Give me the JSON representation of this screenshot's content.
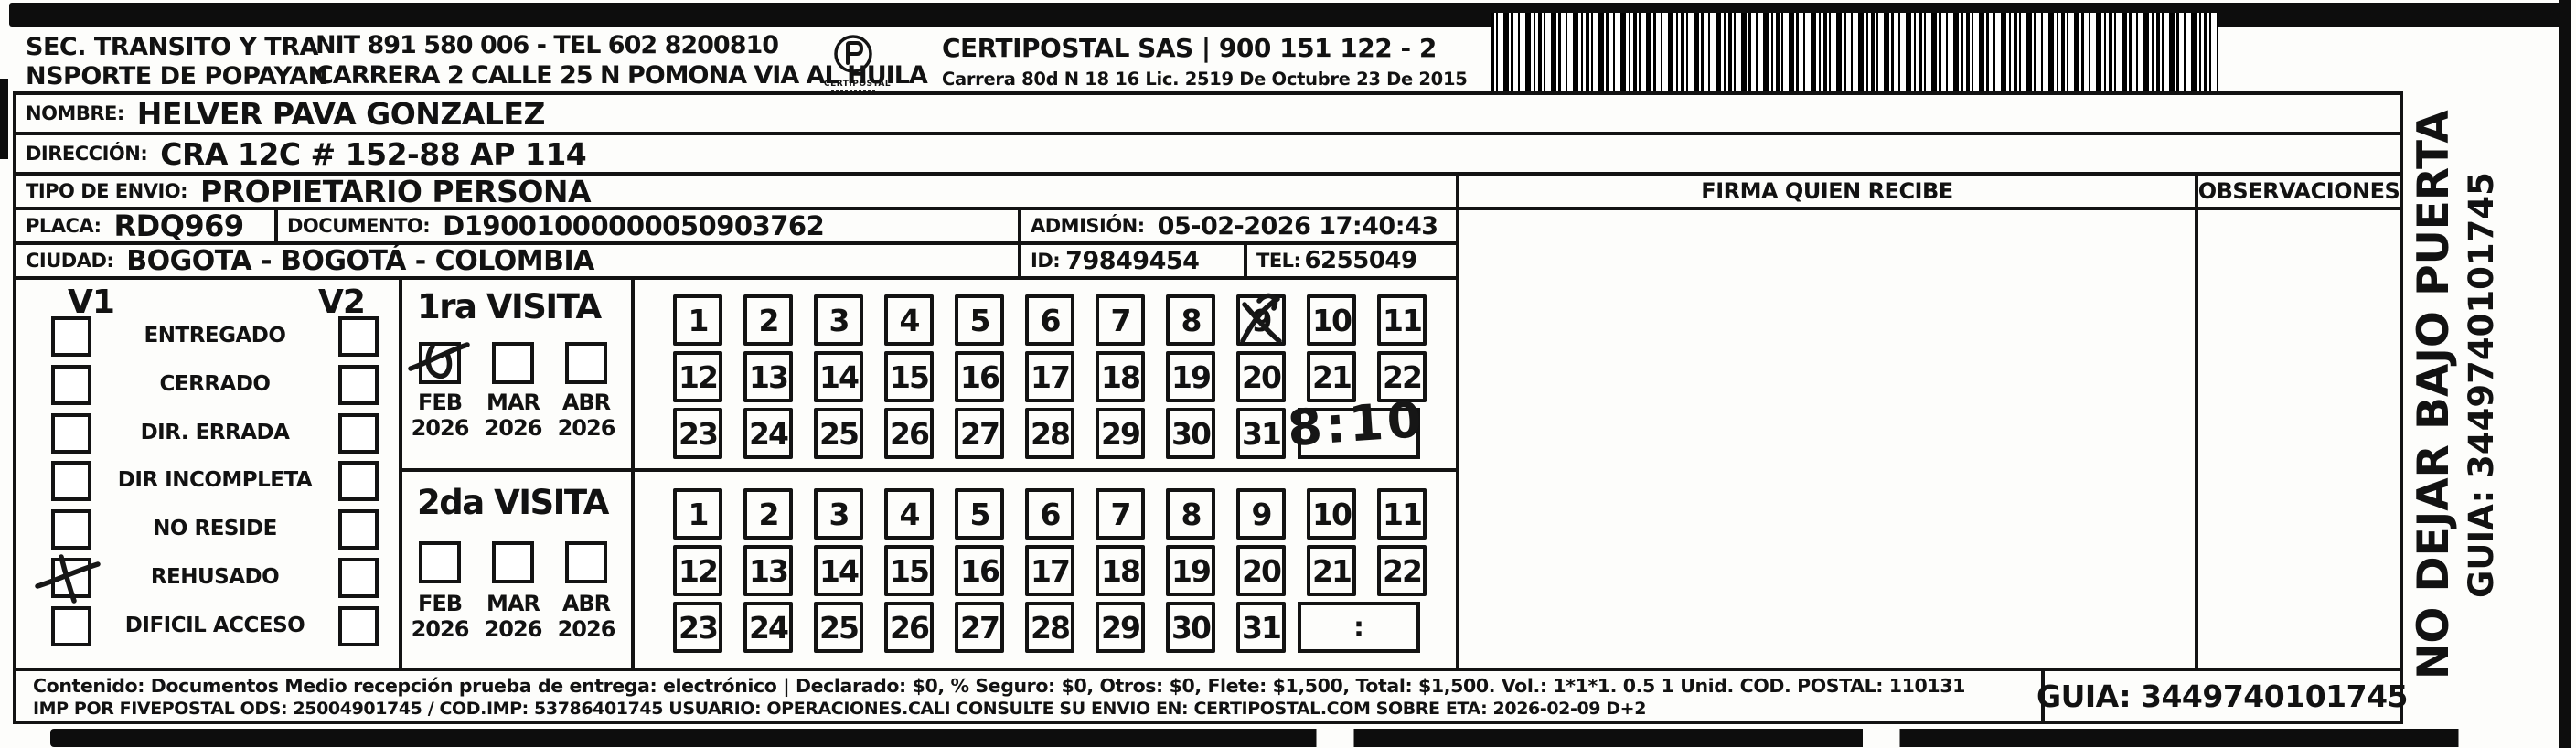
{
  "header": {
    "sender": [
      "SEC. TRANSITO Y TRA",
      "NSPORTE DE POPAYAN"
    ],
    "nit_tel": "NIT 891 580 006 - TEL 602 8200810",
    "sender_address": "CARRERA 2 CALLE 25 N POMONA VIA AL HUILA",
    "logo_text": "CERTIPOSTAL",
    "company": "CERTIPOSTAL SAS | 900 151 122 - 2",
    "company_info": "Carrera 80d N 18 16  Lic. 2519 De Octubre 23 De 2015"
  },
  "fields": {
    "nombre": {
      "label": "NOMBRE:",
      "value": "HELVER PAVA GONZALEZ"
    },
    "direccion": {
      "label": "DIRECCIÓN:",
      "value": "CRA 12C # 152-88 AP 114"
    },
    "tipo_envio": {
      "label": "TIPO DE ENVIO:",
      "value": "PROPIETARIO PERSONA"
    },
    "placa": {
      "label": "PLACA:",
      "value": "RDQ969"
    },
    "documento": {
      "label": "DOCUMENTO:",
      "value": "D19001000000050903762"
    },
    "admision": {
      "label": "ADMISIÓN:",
      "value": "05-02-2026 17:40:43"
    },
    "ciudad": {
      "label": "CIUDAD:",
      "value": "BOGOTA - BOGOTÁ - COLOMBIA"
    },
    "id": {
      "label": "ID:",
      "value": "79849454"
    },
    "tel": {
      "label": "TEL:",
      "value": "6255049"
    }
  },
  "delivery_status": {
    "col1": "V1",
    "col2": "V2",
    "options": [
      "ENTREGADO",
      "CERRADO",
      "DIR. ERRADA",
      "DIR INCOMPLETA",
      "NO RESIDE",
      "REHUSADO",
      "DIFICIL ACCESO"
    ],
    "v1_checked": "REHUSADO"
  },
  "visits": [
    {
      "title": "1ra VISITA",
      "months": [
        "FEB",
        "MAR",
        "ABR"
      ],
      "year": "2026",
      "checked_month": "FEB",
      "marked_day": 9,
      "time_colon": ":",
      "handwritten_time": "8:10"
    },
    {
      "title": "2da VISITA",
      "months": [
        "FEB",
        "MAR",
        "ABR"
      ],
      "year": "2026",
      "checked_month": null,
      "marked_day": null,
      "time_colon": ":",
      "handwritten_time": null
    }
  ],
  "days": [
    "1",
    "2",
    "3",
    "4",
    "5",
    "6",
    "7",
    "8",
    "9",
    "10",
    "11",
    "12",
    "13",
    "14",
    "15",
    "16",
    "17",
    "18",
    "19",
    "20",
    "21",
    "22",
    "23",
    "24",
    "25",
    "26",
    "27",
    "28",
    "29",
    "30",
    "31"
  ],
  "signature": {
    "firma_label": "FIRMA QUIEN RECIBE",
    "observaciones_label": "OBSERVACIONES"
  },
  "side_notice": {
    "line1": "NO DEJAR BAJO PUERTA",
    "line2": "GUIA: 3449740101745"
  },
  "footer": {
    "content_line": "Contenido: Documentos Medio recepción prueba de entrega: electrónico | Declarado: $0, % Seguro: $0, Otros: $0, Flete: $1,500, Total: $1,500. Vol.: 1*1*1. 0.5 1 Unid. COD. POSTAL: 110131",
    "imp_line": "IMP POR FIVEPOSTAL ODS: 25004901745 / COD.IMP: 53786401745 USUARIO: OPERACIONES.CALI CONSULTE SU ENVIO EN: CERTIPOSTAL.COM SOBRE ETA: 2026-02-09 D+2",
    "guia": "GUIA: 3449740101745"
  }
}
